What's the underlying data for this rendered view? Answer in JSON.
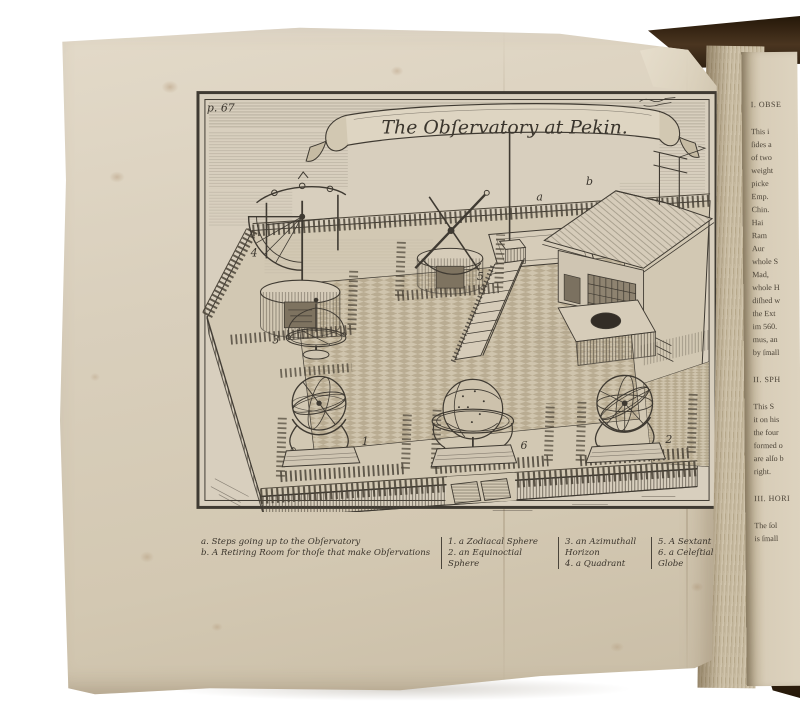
{
  "book": {
    "plate_page": {
      "page_label": "p. 67",
      "banner_title": "The Obſervatory at Pekin.",
      "scene_labels": {
        "steps": "a",
        "retiring_room": "b",
        "zodiacal_sphere": "1",
        "equinoctial_sphere": "2",
        "azimuthal_horizon": "3",
        "quadrant": "4",
        "sextant": "5",
        "celestial_globe": "6"
      },
      "caption": {
        "col1_line1": "a. Steps going up to the Obſervatory",
        "col1_line2": "b. A Retiring Room for thoſe that make Obſervations",
        "col2_line1": "1. a Zodiacal Sphere",
        "col2_line2": "2. an Equinoctial Sphere",
        "col3_line1": "3. an Azimuthall Horizon",
        "col3_line2": "4. a Quadrant",
        "col4_line1": "5. A Sextant",
        "col4_line2": "6. a Celeſtiall Globe"
      }
    },
    "facing_page": {
      "text_fragments": [
        {
          "text": "I. OBSE",
          "cls": "frag-head"
        },
        {
          "text": "This i",
          "gap": 14
        },
        {
          "text": "ſides a"
        },
        {
          "text": "of two"
        },
        {
          "text": "weight"
        },
        {
          "text": "picke"
        },
        {
          "text": "Emp."
        },
        {
          "text": "Chin."
        },
        {
          "text": "Hai"
        },
        {
          "text": "Ram"
        },
        {
          "text": "Aur"
        },
        {
          "text": "whole S"
        },
        {
          "text": "Mad,"
        },
        {
          "text": "whole H"
        },
        {
          "text": "diſhed w"
        },
        {
          "text": "the Ext"
        },
        {
          "text": "im 560."
        },
        {
          "text": "mus, an"
        },
        {
          "text": "by ſmall"
        },
        {
          "text": "II. SPH",
          "cls": "frag-head",
          "gap": 14
        },
        {
          "text": "This S",
          "gap": 14
        },
        {
          "text": "it on his"
        },
        {
          "text": "the four"
        },
        {
          "text": "formed o"
        },
        {
          "text": "are alſo b"
        },
        {
          "text": "right."
        },
        {
          "text": "III. HORI",
          "cls": "frag-head",
          "gap": 14
        },
        {
          "text": "The ſol",
          "gap": 14
        },
        {
          "text": "is ſmall"
        }
      ]
    },
    "colors": {
      "paper": "#d9cfbc",
      "ink": "#3f3a32",
      "cover_leather": "#3b2a1b",
      "fore_edge": "#cfc3ab"
    }
  }
}
